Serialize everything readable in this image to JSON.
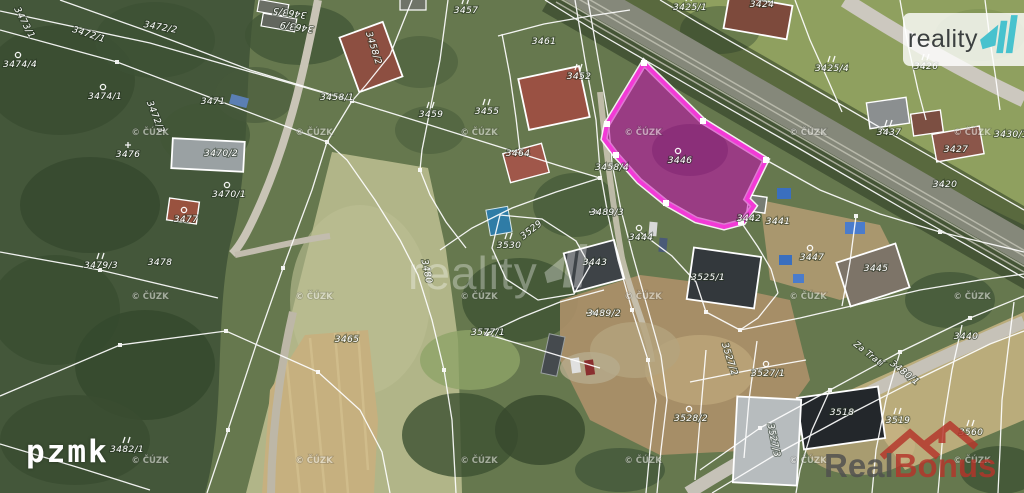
{
  "branding": {
    "reality11": {
      "text": "reality",
      "accent": "#48c2ce",
      "text_color": "#3c4040"
    },
    "center_watermark": {
      "text": "reality"
    },
    "pzmk": "pzmk",
    "realbonus": {
      "real": "Real",
      "bonus": "Bonus",
      "red": "#b5342a",
      "gray": "#4f4f4f"
    }
  },
  "map": {
    "copyright": "© ČÚZK",
    "copyright_grid": {
      "xs": [
        150,
        314,
        479,
        643,
        808,
        972
      ],
      "ys": [
        135,
        299,
        463
      ]
    },
    "highlight": {
      "parcel": "3446",
      "fill": "#cc00b8",
      "stroke": "#f23ad6"
    },
    "parcels": [
      {
        "label": "3463/5",
        "x": 290,
        "y": 10,
        "rot": 188,
        "sym": ""
      },
      {
        "label": "3463/9",
        "x": 297,
        "y": 24,
        "rot": 188,
        "sym": ""
      },
      {
        "label": "3473/1",
        "x": 22,
        "y": 24,
        "rot": 62,
        "sym": ""
      },
      {
        "label": "3472/1",
        "x": 88,
        "y": 37,
        "rot": 18,
        "sym": ""
      },
      {
        "label": "3472/2",
        "x": 160,
        "y": 30,
        "rot": 10,
        "sym": ""
      },
      {
        "label": "3474/4",
        "x": 20,
        "y": 67,
        "rot": 0,
        "sym": "circle"
      },
      {
        "label": "3474/1",
        "x": 105,
        "y": 99,
        "rot": 0,
        "sym": "circle"
      },
      {
        "label": "3472/3",
        "x": 153,
        "y": 118,
        "rot": 68,
        "sym": ""
      },
      {
        "label": "3471",
        "x": 213,
        "y": 104,
        "rot": 0,
        "sym": ""
      },
      {
        "label": "3476",
        "x": 128,
        "y": 157,
        "rot": 0,
        "sym": "cross"
      },
      {
        "label": "3470/2",
        "x": 221,
        "y": 156,
        "rot": 0,
        "sym": ""
      },
      {
        "label": "3470/1",
        "x": 229,
        "y": 197,
        "rot": 0,
        "sym": "circle"
      },
      {
        "label": "3477",
        "x": 186,
        "y": 222,
        "rot": 0,
        "sym": "circle"
      },
      {
        "label": "3479/3",
        "x": 101,
        "y": 268,
        "rot": 0,
        "sym": "ticks"
      },
      {
        "label": "3478",
        "x": 160,
        "y": 265,
        "rot": 0,
        "sym": ""
      },
      {
        "label": "3480",
        "x": 424,
        "y": 272,
        "rot": 78,
        "sym": ""
      },
      {
        "label": "3482/1",
        "x": 127,
        "y": 452,
        "rot": 0,
        "sym": "ticks"
      },
      {
        "label": "3457",
        "x": 466,
        "y": 13,
        "rot": 0,
        "sym": "ticks"
      },
      {
        "label": "3458/2",
        "x": 371,
        "y": 49,
        "rot": 72,
        "sym": ""
      },
      {
        "label": "3458/1",
        "x": 337,
        "y": 100,
        "rot": 0,
        "sym": ""
      },
      {
        "label": "3461",
        "x": 544,
        "y": 44,
        "rot": 0,
        "sym": ""
      },
      {
        "label": "3452",
        "x": 579,
        "y": 79,
        "rot": 0,
        "sym": "ticks"
      },
      {
        "label": "3459",
        "x": 431,
        "y": 117,
        "rot": 0,
        "sym": "ticks"
      },
      {
        "label": "3455",
        "x": 487,
        "y": 114,
        "rot": 0,
        "sym": "ticks"
      },
      {
        "label": "3464",
        "x": 518,
        "y": 156,
        "rot": 0,
        "sym": ""
      },
      {
        "label": "3458/4",
        "x": 612,
        "y": 170,
        "rot": 0,
        "sym": ""
      },
      {
        "label": "3446",
        "x": 680,
        "y": 163,
        "rot": 0,
        "sym": "circle"
      },
      {
        "label": "3489/3",
        "x": 607,
        "y": 215,
        "rot": 0,
        "sym": "arrow"
      },
      {
        "label": "3489/2",
        "x": 604,
        "y": 316,
        "rot": 0,
        "sym": "arrow"
      },
      {
        "label": "3530",
        "x": 509,
        "y": 248,
        "rot": 0,
        "sym": "ticks"
      },
      {
        "label": "3529",
        "x": 533,
        "y": 232,
        "rot": -38,
        "sym": ""
      },
      {
        "label": "3443",
        "x": 595,
        "y": 265,
        "rot": 0,
        "sym": ""
      },
      {
        "label": "3444",
        "x": 641,
        "y": 240,
        "rot": 0,
        "sym": "circle"
      },
      {
        "label": "3425/1",
        "x": 690,
        "y": 10,
        "rot": 0,
        "sym": "ticks"
      },
      {
        "label": "3424",
        "x": 762,
        "y": 7,
        "rot": 0,
        "sym": ""
      },
      {
        "label": "3425/4",
        "x": 832,
        "y": 71,
        "rot": 0,
        "sym": "ticks"
      },
      {
        "label": "3426",
        "x": 926,
        "y": 69,
        "rot": 0,
        "sym": "ticks"
      },
      {
        "label": "3437",
        "x": 889,
        "y": 135,
        "rot": 0,
        "sym": "ticks"
      },
      {
        "label": "3430/1",
        "x": 1011,
        "y": 137,
        "rot": 0,
        "sym": ""
      },
      {
        "label": "3427",
        "x": 956,
        "y": 152,
        "rot": 0,
        "sym": ""
      },
      {
        "label": "3420",
        "x": 945,
        "y": 187,
        "rot": 0,
        "sym": ""
      },
      {
        "label": "3442",
        "x": 749,
        "y": 221,
        "rot": 0,
        "sym": ""
      },
      {
        "label": "3441",
        "x": 778,
        "y": 224,
        "rot": 0,
        "sym": ""
      },
      {
        "label": "3447",
        "x": 812,
        "y": 260,
        "rot": 0,
        "sym": "circle"
      },
      {
        "label": "3445",
        "x": 876,
        "y": 271,
        "rot": 0,
        "sym": ""
      },
      {
        "label": "3525/1",
        "x": 708,
        "y": 280,
        "rot": 0,
        "sym": ""
      },
      {
        "label": "3577/1",
        "x": 488,
        "y": 335,
        "rot": 0,
        "sym": ""
      },
      {
        "label": "3465",
        "x": 347,
        "y": 342,
        "rot": 0,
        "sym": ""
      },
      {
        "label": "3527/2",
        "x": 727,
        "y": 360,
        "rot": 72,
        "sym": ""
      },
      {
        "label": "3527/1",
        "x": 768,
        "y": 376,
        "rot": 0,
        "sym": "circle"
      },
      {
        "label": "3528/2",
        "x": 691,
        "y": 421,
        "rot": 0,
        "sym": "circle"
      },
      {
        "label": "3527/3",
        "x": 771,
        "y": 441,
        "rot": 78,
        "sym": ""
      },
      {
        "label": "3518",
        "x": 842,
        "y": 415,
        "rot": 0,
        "sym": ""
      },
      {
        "label": "3519",
        "x": 898,
        "y": 423,
        "rot": 0,
        "sym": "ticks"
      },
      {
        "label": "3560",
        "x": 971,
        "y": 435,
        "rot": 0,
        "sym": "ticks"
      },
      {
        "label": "3440",
        "x": 966,
        "y": 339,
        "rot": 0,
        "sym": ""
      },
      {
        "label": "Za Tratí",
        "x": 867,
        "y": 356,
        "rot": 38,
        "sym": "street"
      },
      {
        "label": "3480/1",
        "x": 903,
        "y": 375,
        "rot": 38,
        "sym": ""
      }
    ]
  }
}
